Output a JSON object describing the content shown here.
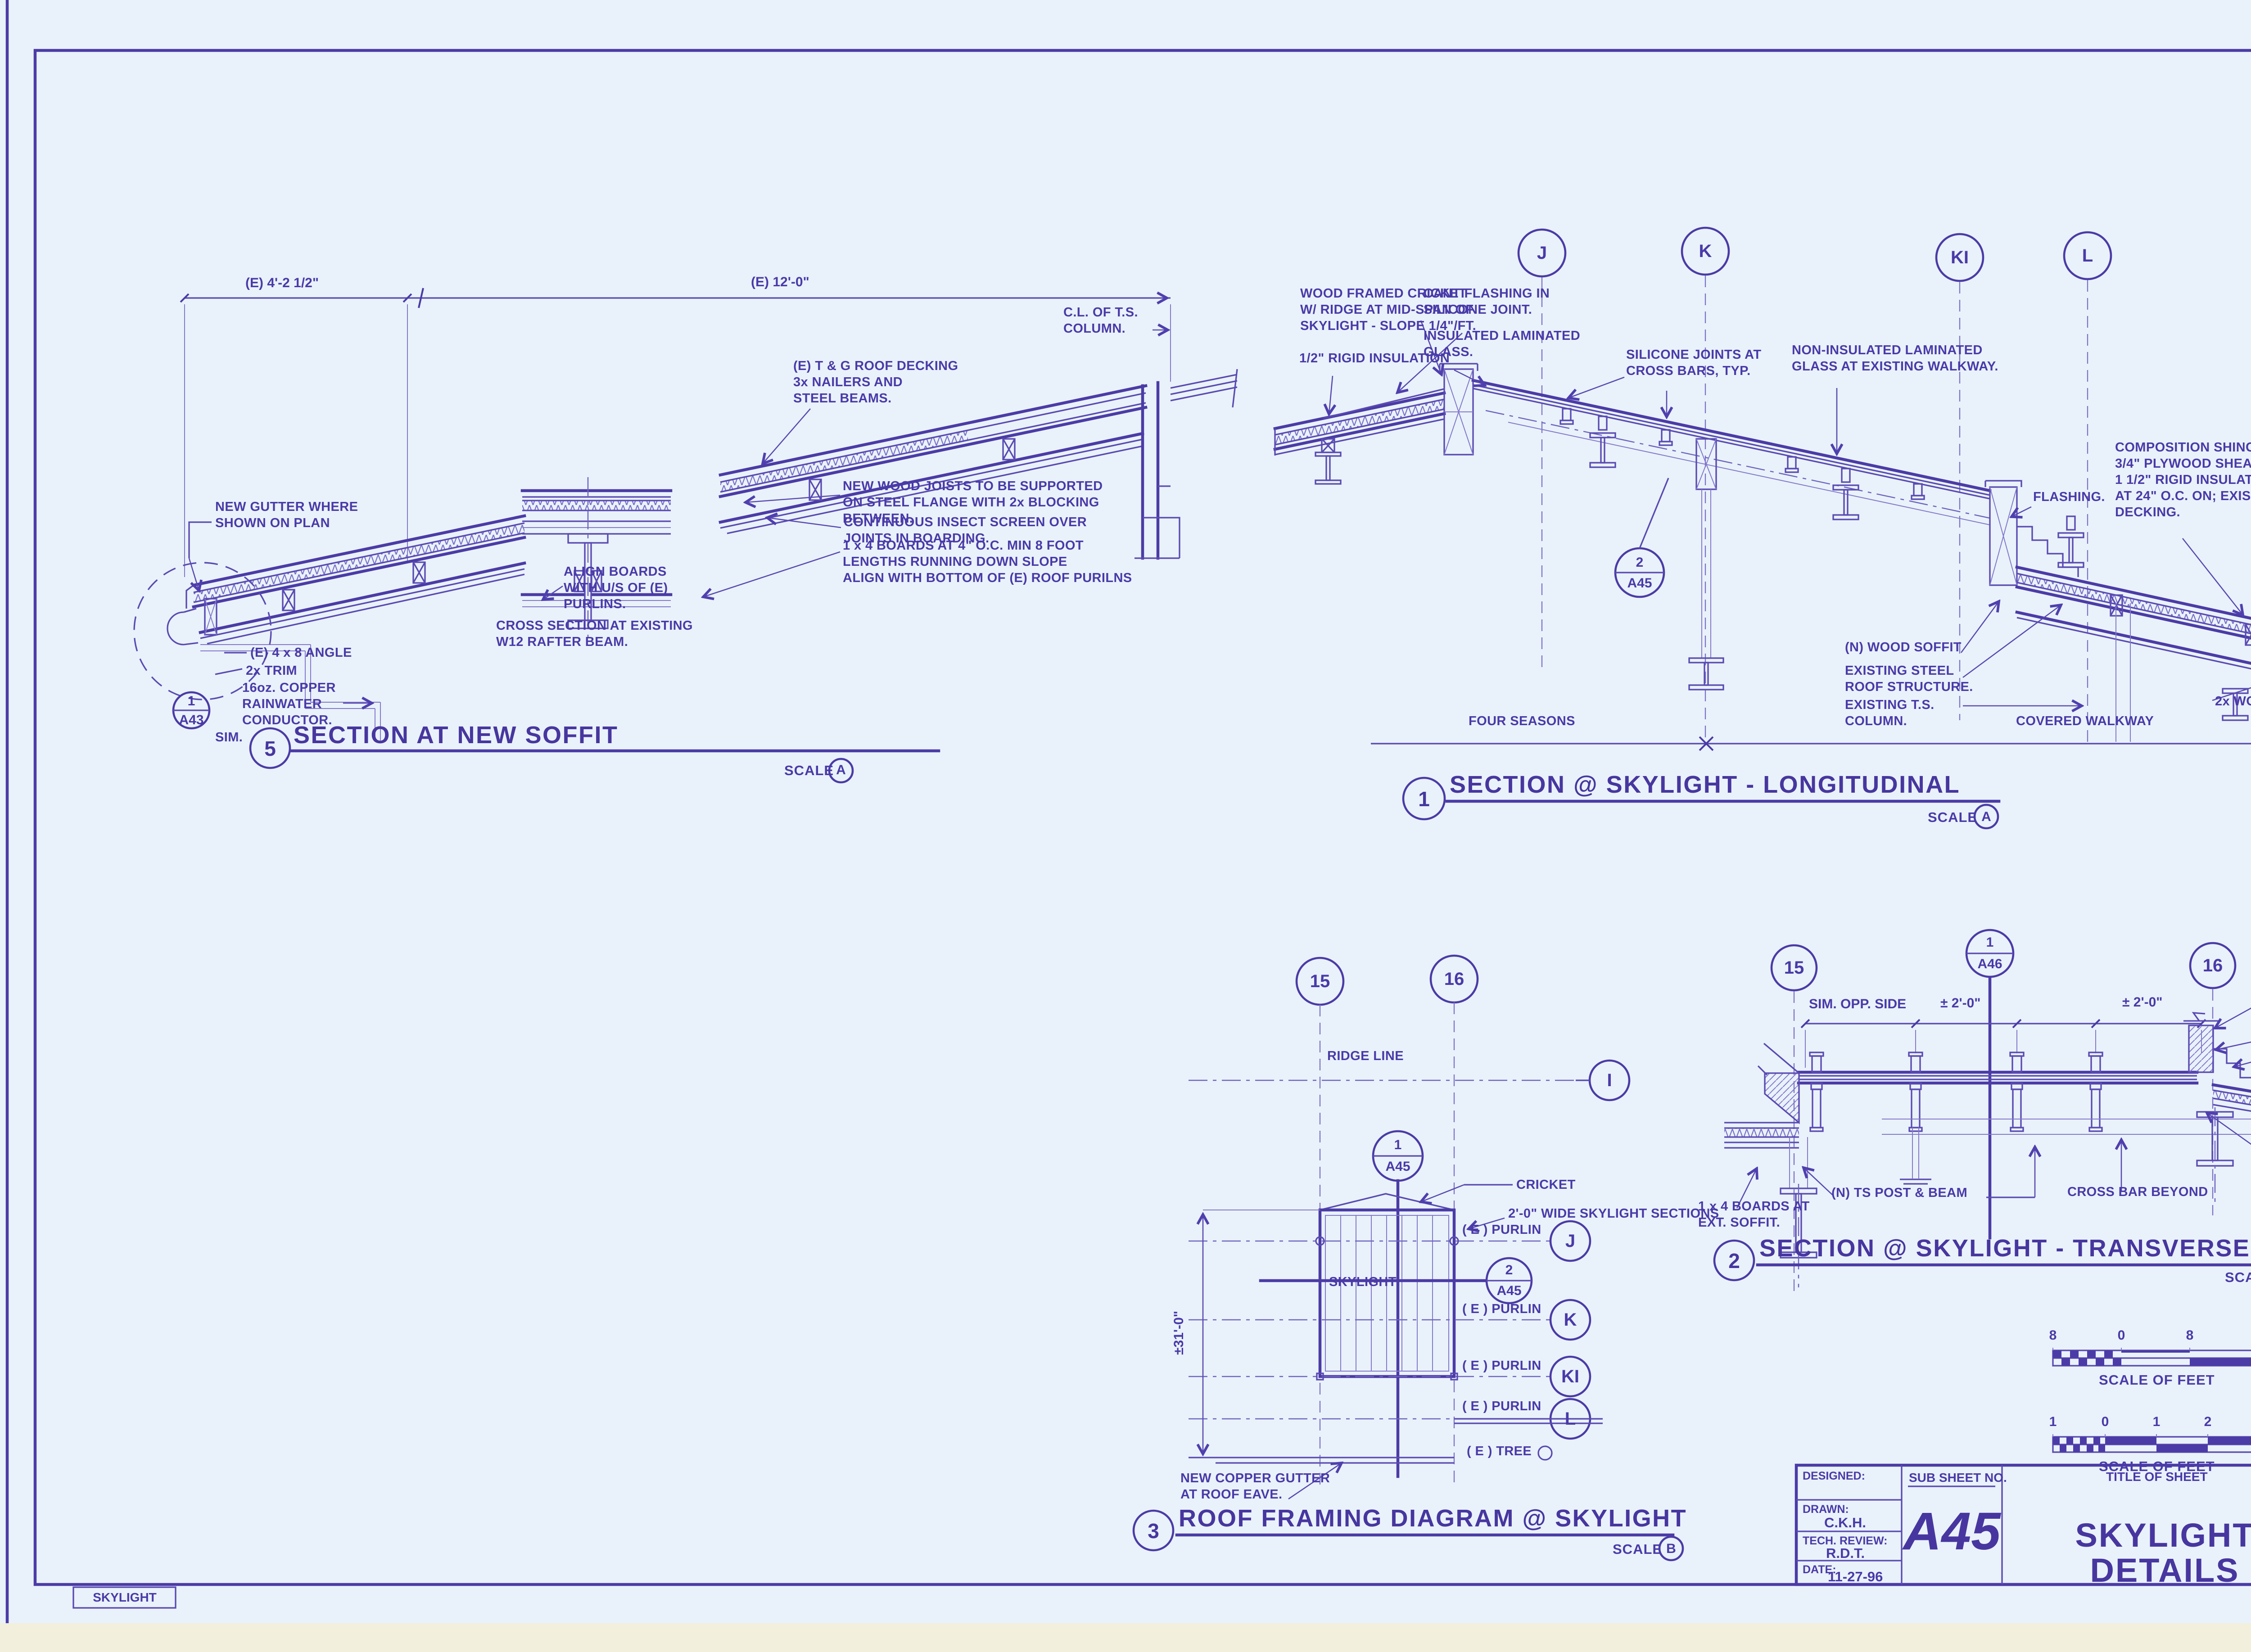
{
  "sheet": {
    "tab": "SKYLIGHT"
  },
  "d5": {
    "num": "5",
    "title": "SECTION AT NEW SOFFIT",
    "scale_word": "SCALE",
    "scale_ref": "A",
    "dim_left": "(E) 4'-2 1/2\"",
    "dim_right": "(E) 12'-0\"",
    "cl_column": [
      "C.L. OF T.S.",
      "COLUMN."
    ],
    "gutter": [
      "NEW GUTTER WHERE",
      "SHOWN ON PLAN"
    ],
    "angle": "(E) 4 x 8 ANGLE",
    "trim": "2x TRIM",
    "copper": [
      "16oz. COPPER",
      "RAINWATER",
      "CONDUCTOR."
    ],
    "bub_top": "1",
    "bub_bot": "A43",
    "sim": "SIM.",
    "align": [
      "ALIGN BOARDS",
      "WITH U/S OF (E)",
      "PURLINS."
    ],
    "cross": [
      "CROSS SECTION AT EXISTING",
      "W12 RAFTER BEAM."
    ],
    "decking": [
      "(E) T & G ROOF DECKING",
      "3x NAILERS AND",
      "STEEL BEAMS."
    ],
    "joists": [
      "NEW WOOD JOISTS TO BE SUPPORTED",
      "ON STEEL FLANGE WITH 2x BLOCKING",
      "BETWEEN."
    ],
    "insect": [
      "CONTINUOUS INSECT SCREEN OVER",
      "JOINTS IN BOARDING."
    ],
    "boards": [
      "1 x 4 BOARDS AT 4\" O.C.  MIN 8 FOOT",
      "LENGTHS RUNNING DOWN SLOPE",
      "ALIGN WITH BOTTOM OF (E)  ROOF PURILNS"
    ]
  },
  "d1": {
    "num": "1",
    "title": "SECTION @ SKYLIGHT - LONGITUDINAL",
    "scale_word": "SCALE",
    "scale_ref": "A",
    "g1": "J",
    "g2": "K",
    "g3": "KI",
    "g4": "L",
    "cricket": [
      "WOOD FRAMED CRICKET",
      "W/ RIDGE AT MID-SPAN OF",
      "SKYLIGHT -  SLOPE 1/4\"/FT."
    ],
    "rigid": "1/2\" RIGID INSULATION",
    "cant": [
      "CANT FLASHING IN",
      "SILICONE JOINT."
    ],
    "insul": [
      "INSULATED LAMINATED",
      "GLASS."
    ],
    "silicone": [
      "SILICONE JOINTS AT",
      "CROSS BARS, TYP."
    ],
    "nonins": [
      "NON-INSULATED LAMINATED",
      "GLASS AT EXISTING WALKWAY."
    ],
    "shingles": [
      "COMPOSITION SHINGLES ON;",
      "3/4\" PLYWOOD SHEATHING ON;",
      "1 1/2\" RIGID INSULATION W/ SPACERS",
      "AT 24\" O.C. ON; EXISTING 2x ROOF",
      "DECKING."
    ],
    "flashing": "FLASHING.",
    "nsoffit": "(N) WOOD SOFFIT",
    "steel": [
      "EXISTING STEEL",
      "ROOF STRUCTURE."
    ],
    "column": [
      "EXISTING T.S.",
      "COLUMN."
    ],
    "trimedge": "2x WOOD TRIM EDGE",
    "bub_top": "2",
    "bub_bot": "A45",
    "zone1": "FOUR SEASONS",
    "zone2": "COVERED WALKWAY"
  },
  "d3": {
    "num": "3",
    "title": "ROOF FRAMING DIAGRAM @ SKYLIGHT",
    "scale_word": "SCALE",
    "scale_ref": "B",
    "g15": "15",
    "g16": "16",
    "gI": "I",
    "gJ": "J",
    "gK": "K",
    "gKI": "KI",
    "gL": "L",
    "ridge": "RIDGE LINE",
    "b1_top": "1",
    "b1_bot": "A45",
    "b2_top": "2",
    "b2_bot": "A45",
    "cricket": "CRICKET",
    "sections": "2'-0\" WIDE SKYLIGHT SECTIONS",
    "skylight": "SKYLIGHT",
    "purlin": "( E ) PURLIN",
    "tree": "( E ) TREE",
    "dim": "±31'-0\"",
    "gutter": [
      "NEW COPPER GUTTER",
      "AT ROOF EAVE."
    ]
  },
  "d2": {
    "num": "2",
    "title": "SECTION @ SKYLIGHT - TRANSVERSE",
    "scale_word": "SCALE",
    "scale_ref": "A",
    "g15": "15",
    "g16": "16",
    "bub_top": "1",
    "bub_bot": "A46",
    "dim1": "SIM. OPP. SIDE",
    "dim2": "± 2'-0\"",
    "dim3": "± 2'-0\"",
    "seal": [
      "EXPANDABLE SEAL AT",
      "TOP OF CURB, TYP."
    ],
    "curb": "2 -2 x 10 CURB.",
    "stepped": "STEPPED FLASHING.",
    "post": "(N) TS POST & BEAM",
    "crossbar": "CROSS BAR BEYOND",
    "boards": [
      "1 x 4 BOARDS AT",
      "EXT. SOFFIT."
    ],
    "trim": [
      "2x WD. TRIM",
      "RESAWN"
    ]
  },
  "bars": {
    "b": {
      "t1": "8",
      "t2": "0",
      "t3": "8",
      "t4": "16",
      "label": "SCALE OF FEET",
      "scale_word": "SCALE",
      "ref": "B"
    },
    "a": {
      "t1": "1",
      "t2": "0",
      "t3": "1",
      "t4": "2",
      "t5": "3",
      "label": "SCALE OF FEET",
      "scale_word": "SCALE",
      "ref": "A"
    }
  },
  "tb": {
    "designed": "DESIGNED:",
    "drawn": "DRAWN:",
    "drawn_v": "C.K.H.",
    "tech": "TECH. REVIEW:",
    "tech_v": "R.D.T.",
    "date": "DATE:",
    "date_v": "11-27-96",
    "sub": "SUB SHEET NO.",
    "sub_v": "A45",
    "title_label": "TITLE OF SHEET",
    "title_v": "SKYLIGHT DETAILS",
    "dno": "DRAWING NO.",
    "dno1": "104",
    "dno2": "70146",
    "pkg1": "PKG.",
    "pkg2": "NO.",
    "sheet": "SHEET",
    "sheet_v": "46",
    "of": "OF",
    "of_v": "101"
  }
}
